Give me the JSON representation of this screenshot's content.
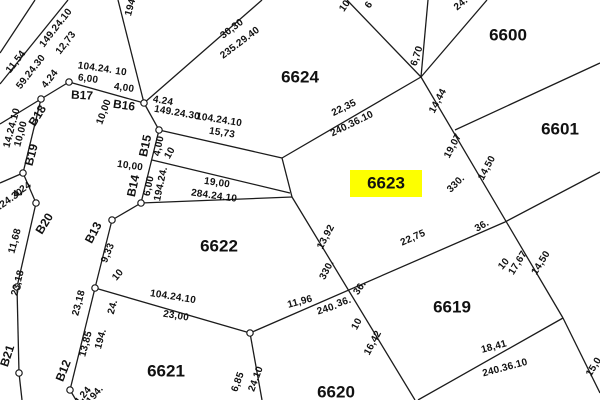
{
  "map": {
    "title": "cadastral-plat-map",
    "width": 600,
    "height": 400,
    "background": "#ffffff",
    "line_color": "#1b1b1b",
    "text_color": "#111111",
    "highlight_color": "#fdff00",
    "highlighted_parcel": "6623",
    "parcel_labels": [
      {
        "id": "6624",
        "x": 300,
        "y": 78,
        "highlighted": false
      },
      {
        "id": "6600",
        "x": 508,
        "y": 36,
        "highlighted": false
      },
      {
        "id": "6601",
        "x": 560,
        "y": 130,
        "highlighted": false
      },
      {
        "id": "6623",
        "x": 386,
        "y": 184,
        "highlighted": true
      },
      {
        "id": "6622",
        "x": 219,
        "y": 247,
        "highlighted": false
      },
      {
        "id": "6621",
        "x": 166,
        "y": 372,
        "highlighted": false
      },
      {
        "id": "6619",
        "x": 452,
        "y": 308,
        "highlighted": false
      },
      {
        "id": "6620",
        "x": 336,
        "y": 393,
        "highlighted": false
      }
    ],
    "node_labels": [
      {
        "t": "B12",
        "x": 64,
        "y": 371,
        "r": -68
      },
      {
        "t": "B13",
        "x": 94,
        "y": 233,
        "r": -62
      },
      {
        "t": "B14",
        "x": 134,
        "y": 186,
        "r": -78
      },
      {
        "t": "B15",
        "x": 146,
        "y": 146,
        "r": -78
      },
      {
        "t": "B16",
        "x": 124,
        "y": 106,
        "r": 8
      },
      {
        "t": "B17",
        "x": 82,
        "y": 96,
        "r": 3
      },
      {
        "t": "B18",
        "x": 38,
        "y": 116,
        "r": -58
      },
      {
        "t": "B19",
        "x": 32,
        "y": 155,
        "r": -75
      },
      {
        "t": "B20",
        "x": 45,
        "y": 224,
        "r": -58
      },
      {
        "t": "B21",
        "x": 8,
        "y": 356,
        "r": -72
      }
    ],
    "dimension_labels": [
      {
        "t": "149.24.10",
        "x": 56,
        "y": 28,
        "r": -52
      },
      {
        "t": "12,73",
        "x": 66,
        "y": 43,
        "r": -52
      },
      {
        "t": "11,54",
        "x": 16,
        "y": 62,
        "r": -52
      },
      {
        "t": "59.24.30",
        "x": 31,
        "y": 72,
        "r": -52
      },
      {
        "t": "4.24",
        "x": 50,
        "y": 79,
        "r": -52
      },
      {
        "t": "104.24.",
        "x": 95,
        "y": 68,
        "r": 8
      },
      {
        "t": "10",
        "x": 121,
        "y": 72,
        "r": 8
      },
      {
        "t": "6,00",
        "x": 88,
        "y": 79,
        "r": 8
      },
      {
        "t": "4,00",
        "x": 124,
        "y": 88,
        "r": 8
      },
      {
        "t": "10,00",
        "x": 104,
        "y": 112,
        "r": -70
      },
      {
        "t": "194.",
        "x": 131,
        "y": 6,
        "r": -75
      },
      {
        "t": "4.24",
        "x": 163,
        "y": 101,
        "r": 10
      },
      {
        "t": "149.24.30",
        "x": 177,
        "y": 113,
        "r": 10
      },
      {
        "t": "104.24.10",
        "x": 219,
        "y": 120,
        "r": 9
      },
      {
        "t": "15,73",
        "x": 222,
        "y": 133,
        "r": 9
      },
      {
        "t": "4,00",
        "x": 159,
        "y": 146,
        "r": -78
      },
      {
        "t": "10",
        "x": 170,
        "y": 153,
        "r": -60
      },
      {
        "t": "10,00",
        "x": 130,
        "y": 166,
        "r": 8
      },
      {
        "t": "6,00",
        "x": 149,
        "y": 186,
        "r": -78
      },
      {
        "t": "194.24.",
        "x": 161,
        "y": 184,
        "r": -78
      },
      {
        "t": "19,00",
        "x": 217,
        "y": 183,
        "r": 8
      },
      {
        "t": "284.24.10",
        "x": 214,
        "y": 196,
        "r": 8
      },
      {
        "t": "30,30",
        "x": 232,
        "y": 29,
        "r": -37
      },
      {
        "t": "235.29.40",
        "x": 240,
        "y": 43,
        "r": -37
      },
      {
        "t": "10",
        "x": 345,
        "y": 6,
        "r": -55
      },
      {
        "t": "6",
        "x": 369,
        "y": 5,
        "r": -55
      },
      {
        "t": "24.",
        "x": 461,
        "y": 4,
        "r": -40
      },
      {
        "t": "22,35",
        "x": 344,
        "y": 108,
        "r": -26
      },
      {
        "t": "240.36.10",
        "x": 352,
        "y": 124,
        "r": -26
      },
      {
        "t": "6,70",
        "x": 417,
        "y": 56,
        "r": -72
      },
      {
        "t": "14,44",
        "x": 438,
        "y": 101,
        "r": -62
      },
      {
        "t": "19,07",
        "x": 453,
        "y": 146,
        "r": -62
      },
      {
        "t": "14,50",
        "x": 487,
        "y": 168,
        "r": -62
      },
      {
        "t": "330.",
        "x": 456,
        "y": 184,
        "r": -45
      },
      {
        "t": "36.",
        "x": 482,
        "y": 226,
        "r": -30
      },
      {
        "t": "10",
        "x": 504,
        "y": 264,
        "r": -50
      },
      {
        "t": "17,67",
        "x": 518,
        "y": 263,
        "r": -58
      },
      {
        "t": "14,50",
        "x": 541,
        "y": 263,
        "r": -58
      },
      {
        "t": "14.24.10",
        "x": 12,
        "y": 128,
        "r": -75
      },
      {
        "t": "10,00",
        "x": 21,
        "y": 134,
        "r": -75
      },
      {
        "t": "4,24",
        "x": 22,
        "y": 190,
        "r": -35
      },
      {
        "t": "9.24.30",
        "x": 8,
        "y": 201,
        "r": -35
      },
      {
        "t": "11,68",
        "x": 15,
        "y": 241,
        "r": -75
      },
      {
        "t": "23,18",
        "x": 18,
        "y": 283,
        "r": -75
      },
      {
        "t": "9,33",
        "x": 108,
        "y": 253,
        "r": -68
      },
      {
        "t": "10",
        "x": 118,
        "y": 275,
        "r": -50
      },
      {
        "t": "23,18",
        "x": 79,
        "y": 303,
        "r": -75
      },
      {
        "t": "24.",
        "x": 113,
        "y": 307,
        "r": -75
      },
      {
        "t": "194.",
        "x": 101,
        "y": 339,
        "r": -75
      },
      {
        "t": "13,85",
        "x": 86,
        "y": 344,
        "r": -75
      },
      {
        "t": "104.24.10",
        "x": 173,
        "y": 297,
        "r": 9
      },
      {
        "t": "23,00",
        "x": 176,
        "y": 316,
        "r": 9
      },
      {
        "t": "4,24",
        "x": 83,
        "y": 396,
        "r": -50
      },
      {
        "t": "194.",
        "x": 95,
        "y": 395,
        "r": -50
      },
      {
        "t": "6,85",
        "x": 238,
        "y": 382,
        "r": -70
      },
      {
        "t": "24.10",
        "x": 256,
        "y": 379,
        "r": -70
      },
      {
        "t": "13,92",
        "x": 326,
        "y": 237,
        "r": -62
      },
      {
        "t": "330.",
        "x": 327,
        "y": 270,
        "r": -62
      },
      {
        "t": "11,96",
        "x": 300,
        "y": 302,
        "r": -15
      },
      {
        "t": "240.",
        "x": 327,
        "y": 309,
        "r": -18
      },
      {
        "t": "36.",
        "x": 344,
        "y": 302,
        "r": -18
      },
      {
        "t": "36.",
        "x": 360,
        "y": 288,
        "r": -55
      },
      {
        "t": "10",
        "x": 357,
        "y": 324,
        "r": -62
      },
      {
        "t": "16,42",
        "x": 373,
        "y": 343,
        "r": -62
      },
      {
        "t": "22,75",
        "x": 413,
        "y": 238,
        "r": -24
      },
      {
        "t": "18,41",
        "x": 494,
        "y": 347,
        "r": -15
      },
      {
        "t": "240.36.10",
        "x": 505,
        "y": 368,
        "r": -15
      },
      {
        "t": "15,0",
        "x": 594,
        "y": 367,
        "r": -58
      }
    ],
    "boundary_lines": [
      [
        0,
        53,
        35,
        0
      ],
      [
        0,
        84,
        68,
        0
      ],
      [
        0,
        124,
        41,
        99
      ],
      [
        41,
        99,
        69,
        82
      ],
      [
        69,
        82,
        144,
        103
      ],
      [
        144,
        103,
        159,
        130
      ],
      [
        159,
        130,
        141,
        203
      ],
      [
        141,
        203,
        112,
        220
      ],
      [
        112,
        220,
        95,
        288
      ],
      [
        95,
        288,
        70,
        390
      ],
      [
        70,
        390,
        76,
        400
      ],
      [
        41,
        99,
        23,
        173
      ],
      [
        23,
        173,
        36,
        203
      ],
      [
        36,
        203,
        17,
        287
      ],
      [
        17,
        287,
        19,
        373
      ],
      [
        19,
        373,
        22,
        400
      ],
      [
        0,
        183,
        23,
        173
      ],
      [
        118,
        0,
        144,
        103
      ],
      [
        144,
        103,
        262,
        0
      ],
      [
        159,
        130,
        282,
        158
      ],
      [
        152,
        160,
        290,
        193
      ],
      [
        141,
        203,
        292,
        197
      ],
      [
        282,
        158,
        292,
        197
      ],
      [
        282,
        158,
        421,
        77
      ],
      [
        347,
        0,
        421,
        77
      ],
      [
        428,
        0,
        421,
        77
      ],
      [
        421,
        77,
        487,
        0
      ],
      [
        421,
        77,
        563,
        318
      ],
      [
        563,
        318,
        600,
        393
      ],
      [
        563,
        318,
        418,
        400
      ],
      [
        455,
        130,
        600,
        63
      ],
      [
        505,
        222,
        600,
        172
      ],
      [
        250,
        333,
        505,
        222
      ],
      [
        292,
        197,
        415,
        400
      ],
      [
        95,
        288,
        250,
        333
      ],
      [
        250,
        333,
        262,
        400
      ]
    ],
    "boundary_nodes": [
      [
        41,
        99
      ],
      [
        69,
        82
      ],
      [
        144,
        103
      ],
      [
        159,
        130
      ],
      [
        141,
        203
      ],
      [
        112,
        220
      ],
      [
        95,
        288
      ],
      [
        70,
        390
      ],
      [
        23,
        173
      ],
      [
        36,
        203
      ],
      [
        17,
        287
      ],
      [
        19,
        373
      ],
      [
        250,
        333
      ]
    ]
  }
}
